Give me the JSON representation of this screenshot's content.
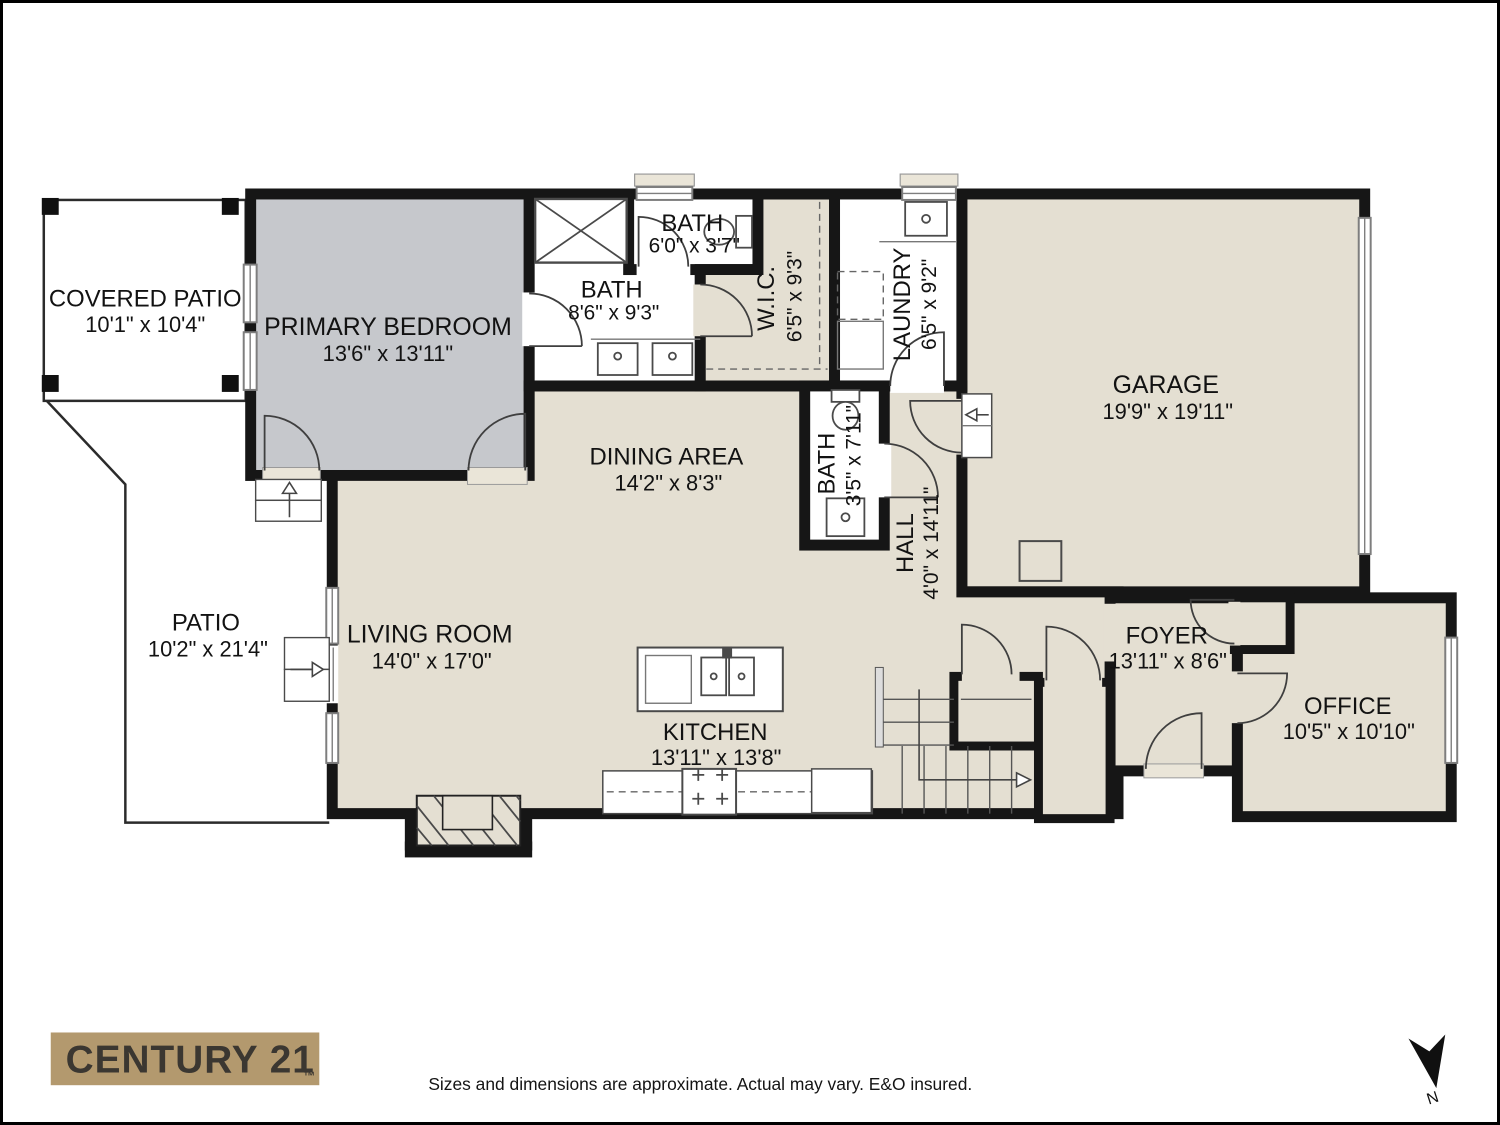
{
  "page": {
    "title": "Floor Plan"
  },
  "colors": {
    "floor": "#e4dfd2",
    "bedroom": "#c6c8cc",
    "wall": "#161616",
    "sill": "#eae5d8",
    "logo_bg": "#b3996e",
    "logo_fg": "#3b3731"
  },
  "rooms": [
    {
      "id": "covered-patio",
      "name": "COVERED PATIO",
      "dims": "10'1\" x 10'4\""
    },
    {
      "id": "primary-bedroom",
      "name": "PRIMARY BEDROOM",
      "dims": "13'6\" x 13'11\""
    },
    {
      "id": "bath-primary",
      "name": "BATH",
      "dims": "8'6\" x 9'3\""
    },
    {
      "id": "bath-shower",
      "name": "BATH",
      "dims": "6'0\" x 3'7\""
    },
    {
      "id": "wic",
      "name": "W.I.C.",
      "dims": "6'5\" x 9'3\""
    },
    {
      "id": "laundry",
      "name": "LAUNDRY",
      "dims": "6'5\" x 9'2\""
    },
    {
      "id": "garage",
      "name": "GARAGE",
      "dims": "19'9\" x 19'11\""
    },
    {
      "id": "dining",
      "name": "DINING AREA",
      "dims": "14'2\" x 8'3\""
    },
    {
      "id": "bath-hall",
      "name": "BATH",
      "dims": "3'5\" x 7'11\""
    },
    {
      "id": "hall",
      "name": "HALL",
      "dims": "4'0\" x 14'11\""
    },
    {
      "id": "living",
      "name": "LIVING ROOM",
      "dims": "14'0\" x 17'0\""
    },
    {
      "id": "patio",
      "name": "PATIO",
      "dims": "10'2\" x 21'4\""
    },
    {
      "id": "kitchen",
      "name": "KITCHEN",
      "dims": "13'11\" x 13'8\""
    },
    {
      "id": "foyer",
      "name": "FOYER",
      "dims": "13'11\" x 8'6\""
    },
    {
      "id": "office",
      "name": "OFFICE",
      "dims": "10'5\" x 10'10\""
    }
  ],
  "branding": {
    "logo_text": "CENTURY 21",
    "logo_tm": "™"
  },
  "footer": {
    "disclaimer": "Sizes and dimensions are approximate. Actual may vary. E&O insured."
  },
  "compass": {
    "label": "N"
  }
}
